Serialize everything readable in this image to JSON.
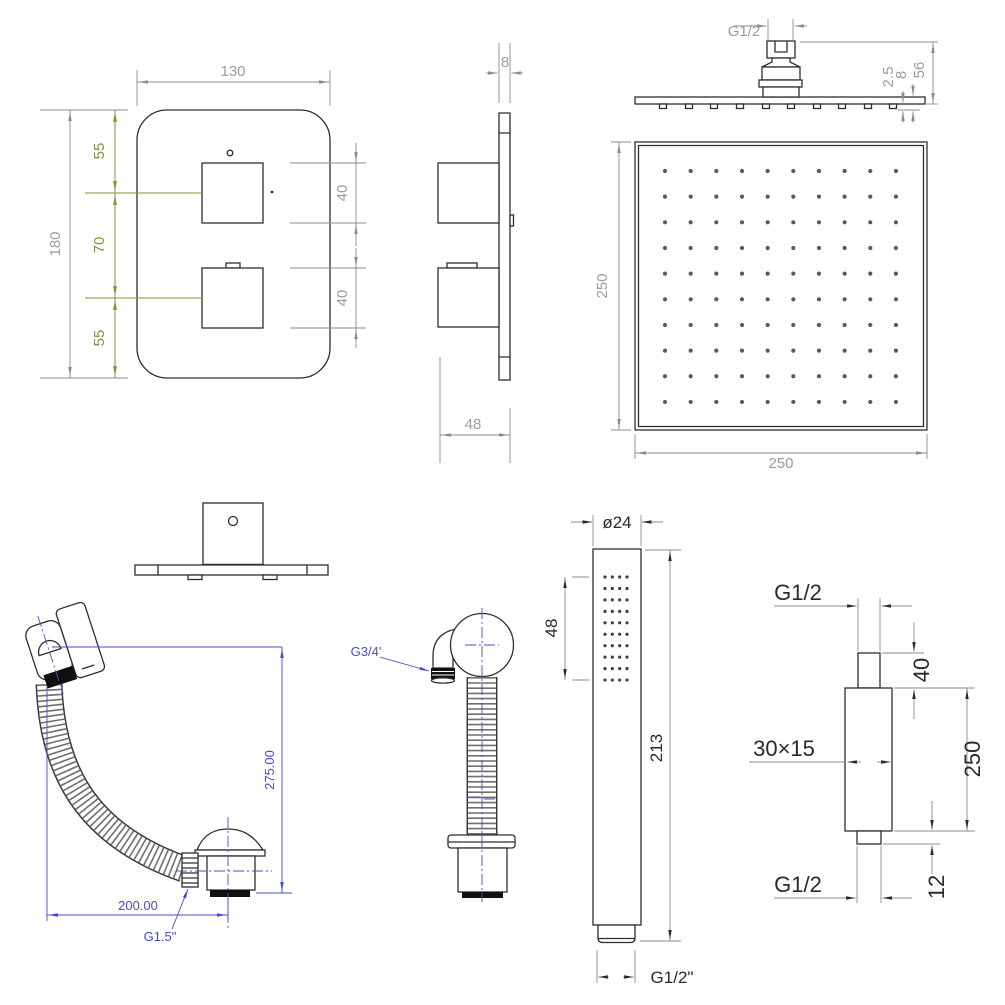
{
  "document": {
    "type": "technical-drawing",
    "product": "shower-set dimensional drawing"
  },
  "colors": {
    "line": "#2e2e2e",
    "dimension": "#8c8c8c",
    "dimension_text": "#9c9c9c",
    "accent_olive": "#8f8f3a",
    "accent_blue": "#4949ce",
    "dark_text": "#2a2a2a",
    "background": "#ffffff"
  },
  "views": {
    "valve_front": {
      "width": "130",
      "height": "180",
      "seg_top": "55",
      "seg_mid": "70",
      "seg_bot": "55",
      "knob_upper": "40",
      "knob_lower": "40"
    },
    "valve_side": {
      "thickness": "8",
      "depth": "48"
    },
    "head_side": {
      "thread": "G1/2",
      "protrusion": "2.5",
      "plate_thickness": "8",
      "height": "56"
    },
    "head_plan": {
      "width": "250",
      "height": "250",
      "rows": 10,
      "cols": 10
    },
    "bath_waste": {
      "height": "275.00",
      "reach": "200.00",
      "thread": "G1.5\""
    },
    "outlet_elbow": {
      "thread": "G3/4'"
    },
    "hand_shower": {
      "diameter": "ø24",
      "spray_length": "48",
      "total_length": "213",
      "thread": "G1/2\"",
      "rows": 10,
      "cols": 4
    },
    "wall_arm": {
      "thread_top": "G1/2",
      "neck_length": "40",
      "body_length": "250",
      "section": "30×15",
      "thread_bottom": "G1/2",
      "tail_length": "12"
    }
  }
}
